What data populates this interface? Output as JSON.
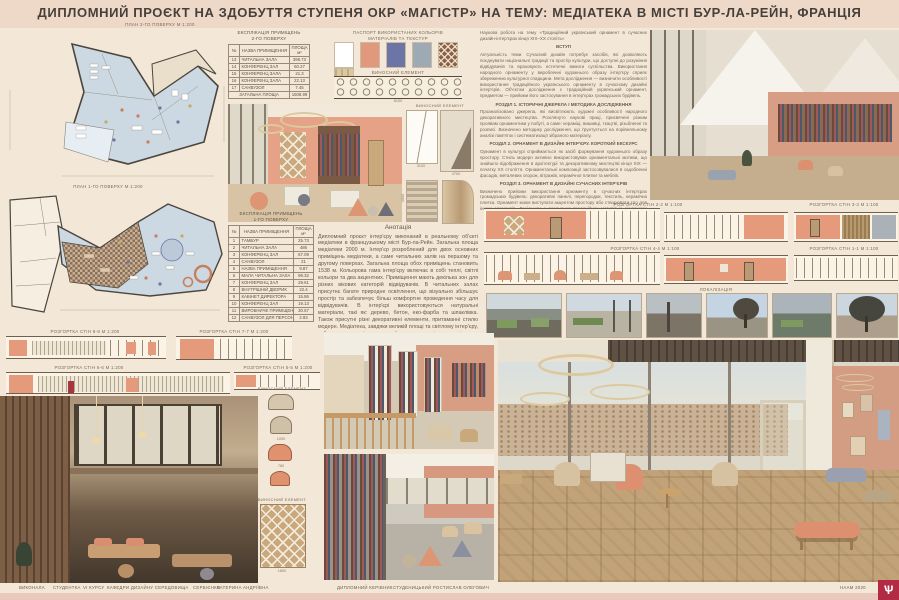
{
  "header": {
    "title": "ДИПЛОМНИЙ ПРОЄКТ НА ЗДОБУТТЯ СТУПЕНЯ ОКР «МАГІСТР» НА ТЕМУ: МЕДІАТЕКА В МІСТІ БУР-ЛА-РЕЙН, ФРАНЦІЯ"
  },
  "plans": {
    "plan2_caption": "ПЛАН 2-ГО ПОВЕРХУ М 1:200",
    "plan1_caption": "ПЛАН 1-ГО ПОВЕРХУ М 1:200"
  },
  "explication2": {
    "title1": "ЕКСПЛІКАЦІЯ ПРИМІЩЕНЬ",
    "title2": "2-ГО ПОВЕРХУ",
    "col_num": "№",
    "col_name": "НАЗВА ПРИМІЩЕННЯ",
    "col_area1": "ПЛОЩА",
    "col_area2": "м²",
    "rows": [
      [
        "13",
        "ЧИТАЛЬНА ЗАЛА",
        "396.73"
      ],
      [
        "14",
        "КОНФЕРЕНЦ ЗАЛ",
        "60.27"
      ],
      [
        "15",
        "КОНФЕРЕНЦ ЗАЛА",
        "21.3"
      ],
      [
        "16",
        "КОНФЕРЕНЦ ЗАЛА",
        "22.13"
      ],
      [
        "17",
        "САНВУЗОЛ",
        "7.45"
      ]
    ],
    "total_label": "ЗАГАЛЬНА ПЛОЩА",
    "total_value": "1508.99"
  },
  "explication1": {
    "title1": "ЕКСПЛІКАЦІЯ ПРИМІЩЕНЬ",
    "title2": "1-ГО ПОВЕРХУ",
    "col_num": "№",
    "col_name": "НАЗВА ПРИМІЩЕННЯ",
    "col_area1": "ПЛОЩА",
    "col_area2": "м²",
    "rows": [
      [
        "1",
        "ТАМБУР",
        "25.73"
      ],
      [
        "2",
        "ЧИТАЛЬНА ЗАЛА",
        "486"
      ],
      [
        "3",
        "КОНФЕРЕНЦ ЗАЛ",
        "67.09"
      ],
      [
        "4",
        "САНВУЗОЛ",
        "21"
      ],
      [
        "5",
        "НАЗВА ПРИМІЩЕННЯ",
        "9.87"
      ],
      [
        "6",
        "МАЛА ЧИТАЛЬНА ЗАЛА",
        "99.32"
      ],
      [
        "7",
        "КОНФЕРЕНЦ ЗАЛ",
        "29.61"
      ],
      [
        "8",
        "ВНУТРІШНІЙ ДВОРИК",
        "22.4"
      ],
      [
        "9",
        "КАБІНЕТ ДИРЕКТОРА",
        "15.86"
      ],
      [
        "10",
        "КОНФЕРЕНЦ ЗАЛ",
        "19.13"
      ],
      [
        "11",
        "ВИРОБНИЧЕ ПРИМІЩЕННЯ",
        "30.57"
      ],
      [
        "12",
        "САНВУЗОЛ ДЛЯ ПЕРСОНАЛУ",
        "2.93"
      ]
    ]
  },
  "palette": {
    "title1": "ПАСПОРТ ВИКОРИСТАНИХ КОЛЬОРІВ",
    "title2": "МАТЕРІАЛІВ ТА ТЕКСТУР",
    "swatches": [
      {
        "name": "white",
        "hex": "#ffffff"
      },
      {
        "name": "salmon",
        "hex": "#e2987c"
      },
      {
        "name": "blue-violet",
        "hex": "#6d74a6"
      },
      {
        "name": "gray-blue",
        "hex": "#9eaab3"
      },
      {
        "name": "ornament-tile",
        "hex": "#8a5f44"
      },
      {
        "name": "light-wood",
        "hex": "#dbc7a0"
      }
    ]
  },
  "details": {
    "label": "ВИНОСНИЙ ЕЛЕМЕНТ",
    "railing_dim": "8100",
    "curtain_dim": "3100",
    "shade_dim": "4700",
    "stripe_dim": "4000",
    "chair_dim1": "1000",
    "chair_dim2": "780",
    "ornament_dim": "1800"
  },
  "sections": {
    "s88": "РОЗГОРТКА СТІН 8-8 М 1:200",
    "s77": "РОЗГОРТКА СТІН 7-7 М 1:200",
    "s66": "РОЗГОРТКА СТІН 6-6 М 1:200",
    "s55": "РОЗГОРТКА СТІН 5-5 М 1:200",
    "s22": "РОЗГОРТКА СТІН 2-2 М 1:100",
    "s33": "РОЗГОРТКА СТІН 3-3 М 1:100",
    "s44": "РОЗГОРТКА СТІН 4-4 М 1:100",
    "s11": "РОЗГОРТКА СТІН 1-1 М 1:100"
  },
  "localization": {
    "label": "ЛОКАЛІЗАЦІЯ"
  },
  "annotation": {
    "title": "Анотація",
    "text": "Дипломний проєкт інтер'єру виконаний в реальному об'єкті медіатеки в французькому місті Бур-ла-Рейн. Загальна площа медіатеки 2000 м. Інтер'єр розроблений для двох основних приміщень медіатеки, а саме читальних залів на першому та другому поверхах. Загальна площа обох приміщень становить 1538 м. Кольорова гама інтер'єру включає в собі теплі, світлі кольори та два акцентних. Приміщення мають декілька зон для різних вікових категорій відвідувачів. В читальних залах присутнє багате природне освітлення, що візуально збільшує простір та забезпечує більш комфортне проведення часу для відвідувачів. В інтер'єрі використовуються натуральні матеріали, такі як: дерево, бетон, еко-фарба та шпаклівка. Також присутні різні декоративні елементи, притаманні стилю модерн. Медіатека, завдяки великій площі та світлому інтер'єру, забезпечує простір для комфортного та цікавого спільного проведення часу і отримання інформації для відвідувачів усіх вікових категорій."
  },
  "research": {
    "lead": "Наукова робота на тему «Традиційний український орнамент в сучасних дизайн-інтер'єрах кінця XIX–XX століть»",
    "h_intro": "ВСТУП",
    "p_intro": "Актуальність теми. Сучасний дизайн потребує засобів, які дозволяють поєднувати національні традиції та простір культури, що доступні до розуміння відвідувачів та враховують естетичні вимоги суспільства. Використання народного орнаменту у виробленні художнього образу інтер'єру сприяє збереженню культурної спадщини. Мета дослідження — визначити особливості використання традиційного українського орнаменту в сучасному дизайні інтер'єрів. Об'єктом дослідження є традиційний український орнамент, предметом — прийоми його застосування в інтер'єрах громадських будівель.",
    "h1": "РОЗДІЛ 1. ІСТОРИЧНІ ДЖЕРЕЛА І МЕТОДИКА ДОСЛІДЖЕННЯ",
    "p1": "Проаналізовано джерела, які висвітлюють художні особливості народного декоративного мистецтва. Розглянуто наукові праці, присвячені різним проявам орнаментики у побуті, а саме: кераміці, вишивці, ткацтві, різьбленні та розписі. Визначено методику дослідження, що ґрунтується на порівняльному аналізі пам'яток і систематизації зібраного матеріалу.",
    "h2": "РОЗДІЛ 2. ОРНАМЕНТ В ДИЗАЙНІ ІНТЕР'ЄРУ. КОРОТКИЙ ЕКСКУРС",
    "p2": "Орнамент в культурі сприймається як засіб формування художнього образу простору. Стиль модерн активно використовував орнаментальні мотиви, що знайшло відображення в архітектурі та декоративному мистецтві кінця XIX — початку XX століття. Орнаментальні композиції застосовувалися в оздобленні фасадів, металевих огорож, вітражів, керамічної плитки та меблів.",
    "h3": "РОЗДІЛ 3. ОРНАМЕНТ В ДИЗАЙНІ СУЧАСНИХ ІНТЕР'ЄРІВ",
    "p3": "Визначено прийоми використання орнаменту в сучасних інтер'єрах громадських будівель: декоративні панелі, перегородки, текстиль, керамічна плитка. Орнамент може виступати акцентом простору або створювати тло для інших елементів. Доцільним є поєднання традиційних мотивів із сучасними матеріалами — деревом, бетоном, металом та склом.",
    "h_concl": "ВИСНОВКИ",
    "p_concl": "В результаті дослідження визначено особливості використання традиційного українського орнаменту в сучасному дизайні інтер'єрів. Розроблено проєкт інтер'єру медіатеки, в якому застосовано орнаментальні мотиви у вигляді декоративних панелей та елементів огорожі. Запропоновані рішення забезпечують цілісність художнього образу та комфортне перебування відвідувачів у сучасних інтер'єрах в Україні."
  },
  "footer": {
    "performed": "ВИКОНАЛА",
    "student": "СТУДЕНТКА",
    "course": "VI КУРСУ",
    "department": "КАФЕДРИ ДИЗАЙНУ СЕРЕДОВИЩА",
    "surname": "СЕРБІЄНКО",
    "name": "КАТЕРИНА",
    "patronymic": "АНДРІЇВНА",
    "supervisor_label": "ДИПЛОМНИЙ КЕРІВНИК",
    "supervisor_name": "СТУДЕНИЦЬКИЙ РОСТИСЛАВ ОЛЕГОВИЧ",
    "academy_year": "НААМ 2020",
    "logo_glyph": "Ѱ"
  }
}
